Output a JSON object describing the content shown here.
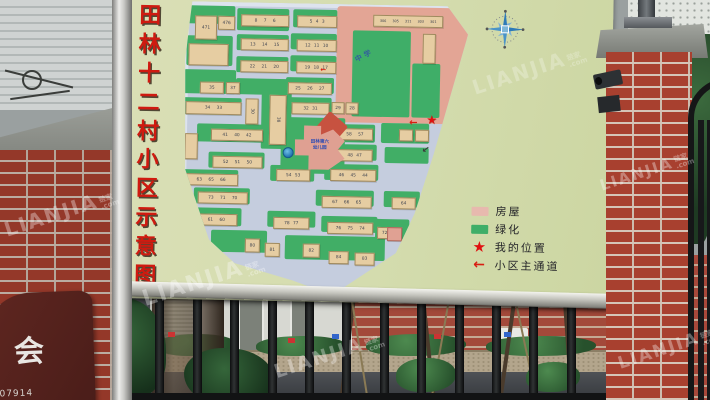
{
  "watermark": {
    "text": "LIANJIA",
    "cn": "链家",
    "com": ".com"
  },
  "left_sign": {
    "char": "会",
    "number": "07914"
  },
  "board": {
    "title_chars": [
      "田",
      "林",
      "十",
      "二",
      "村",
      "小",
      "区",
      "示",
      "意",
      "图"
    ],
    "top_road_label": "田林东路",
    "legend": [
      {
        "key": "house",
        "label": "房屋"
      },
      {
        "key": "green",
        "label": "绿化"
      },
      {
        "key": "star",
        "label": "我的位置"
      },
      {
        "key": "arrow",
        "label": "小区主通道"
      }
    ],
    "colors": {
      "board_face": "#d6dcae",
      "house": "#e6cda2",
      "green": "#41ae66",
      "road": "#c5cdde",
      "pink_zone": "#e3a595",
      "legend_house": "#e7b9ae",
      "marker_red": "#d81e12",
      "title_red": "#cf1a10"
    },
    "map": {
      "school_label": "中学",
      "kindergarten_lines": [
        "田林第六",
        "幼儿园"
      ],
      "greens": [
        [
          2,
          4,
          48,
          18
        ],
        [
          52,
          6,
          52,
          22
        ],
        [
          108,
          6,
          44,
          18
        ],
        [
          2,
          34,
          46,
          30
        ],
        [
          52,
          32,
          52,
          16
        ],
        [
          106,
          30,
          46,
          16
        ],
        [
          0,
          68,
          52,
          24
        ],
        [
          52,
          54,
          52,
          16
        ],
        [
          106,
          52,
          46,
          16
        ],
        [
          0,
          96,
          58,
          17
        ],
        [
          52,
          76,
          52,
          16
        ],
        [
          102,
          74,
          48,
          16
        ],
        [
          78,
          88,
          30,
          58
        ],
        [
          102,
          94,
          46,
          16
        ],
        [
          14,
          122,
          70,
          18
        ],
        [
          98,
          114,
          64,
          56
        ],
        [
          26,
          150,
          56,
          16
        ],
        [
          0,
          168,
          56,
          16
        ],
        [
          88,
          162,
          44,
          16
        ],
        [
          138,
          120,
          54,
          18
        ],
        [
          146,
          140,
          48,
          16
        ],
        [
          142,
          160,
          54,
          16
        ],
        [
          12,
          186,
          56,
          16
        ],
        [
          134,
          186,
          58,
          16
        ],
        [
          198,
          118,
          48,
          20
        ],
        [
          202,
          142,
          44,
          16
        ],
        [
          0,
          206,
          60,
          18
        ],
        [
          86,
          208,
          48,
          16
        ],
        [
          140,
          212,
          56,
          16
        ],
        [
          202,
          186,
          36,
          16
        ],
        [
          30,
          228,
          56,
          22
        ],
        [
          104,
          232,
          100,
          24
        ],
        [
          194,
          214,
          34,
          20
        ]
      ],
      "school_greens": [
        [
          168,
          26,
          58,
          86
        ],
        [
          228,
          58,
          28,
          54
        ]
      ],
      "buildings": [
        {
          "n": "471",
          "x": 10,
          "y": 14,
          "w": 20,
          "h": 22
        },
        {
          "n": "476",
          "x": 33,
          "y": 14,
          "w": 15,
          "h": 12
        },
        {
          "n": "8 7 6",
          "x": 56,
          "y": 12,
          "w": 46,
          "h": 10
        },
        {
          "n": "5 4 3",
          "x": 112,
          "y": 12,
          "w": 38,
          "h": 10
        },
        {
          "n": "306 305 311 303 301",
          "x": 188,
          "y": 10,
          "w": 68,
          "h": 10,
          "fs": 3.4
        },
        {
          "n": "",
          "x": 4,
          "y": 42,
          "w": 38,
          "h": 20
        },
        {
          "n": "13 14 15",
          "x": 56,
          "y": 36,
          "w": 46,
          "h": 10
        },
        {
          "n": "12 11 10",
          "x": 112,
          "y": 36,
          "w": 38,
          "h": 10
        },
        {
          "n": "22 21 20",
          "x": 56,
          "y": 58,
          "w": 46,
          "h": 10
        },
        {
          "n": "19 18 17",
          "x": 112,
          "y": 58,
          "w": 38,
          "h": 10
        },
        {
          "n": "35",
          "x": 16,
          "y": 80,
          "w": 22,
          "h": 10
        },
        {
          "n": "37",
          "x": 42,
          "y": 80,
          "w": 12,
          "h": 10
        },
        {
          "n": "25 26 27",
          "x": 104,
          "y": 79,
          "w": 42,
          "h": 10
        },
        {
          "n": "34 33",
          "x": 2,
          "y": 100,
          "w": 54,
          "h": 11
        },
        {
          "n": "30",
          "x": 62,
          "y": 96,
          "w": 11,
          "h": 24,
          "v": 1
        },
        {
          "n": "38",
          "x": 86,
          "y": 92,
          "w": 15,
          "h": 48,
          "v": 1
        },
        {
          "n": "32 31",
          "x": 108,
          "y": 99,
          "w": 36,
          "h": 10
        },
        {
          "n": "29",
          "x": 148,
          "y": 98,
          "w": 11,
          "h": 10
        },
        {
          "n": "28",
          "x": 162,
          "y": 98,
          "w": 11,
          "h": 10
        },
        {
          "n": "41 40 42",
          "x": 28,
          "y": 127,
          "w": 50,
          "h": 10
        },
        {
          "n": "",
          "x": 2,
          "y": 132,
          "w": 11,
          "h": 24
        },
        {
          "n": "59 58 57",
          "x": 142,
          "y": 124,
          "w": 46,
          "h": 10
        },
        {
          "n": "48 47",
          "x": 154,
          "y": 145,
          "w": 34,
          "h": 10
        },
        {
          "n": "46 45 44",
          "x": 148,
          "y": 165,
          "w": 44,
          "h": 10
        },
        {
          "n": "",
          "x": 216,
          "y": 124,
          "w": 12,
          "h": 10
        },
        {
          "n": "",
          "x": 232,
          "y": 124,
          "w": 12,
          "h": 10
        },
        {
          "n": "64",
          "x": 210,
          "y": 192,
          "w": 22,
          "h": 10
        },
        {
          "n": "52 51 50",
          "x": 30,
          "y": 154,
          "w": 48,
          "h": 10
        },
        {
          "n": "63 65 66",
          "x": 2,
          "y": 172,
          "w": 52,
          "h": 10
        },
        {
          "n": "54 53",
          "x": 94,
          "y": 166,
          "w": 32,
          "h": 10
        },
        {
          "n": "73 71 70",
          "x": 16,
          "y": 190,
          "w": 48,
          "h": 10
        },
        {
          "n": "67 66 65",
          "x": 140,
          "y": 192,
          "w": 48,
          "h": 10
        },
        {
          "n": "62 61 60",
          "x": 2,
          "y": 212,
          "w": 52,
          "h": 10
        },
        {
          "n": "78 77",
          "x": 92,
          "y": 214,
          "w": 34,
          "h": 10
        },
        {
          "n": "76 75 74",
          "x": 146,
          "y": 218,
          "w": 44,
          "h": 10
        },
        {
          "n": "72",
          "x": 196,
          "y": 222,
          "w": 13,
          "h": 10
        },
        {
          "n": "80",
          "x": 64,
          "y": 236,
          "w": 13,
          "h": 12
        },
        {
          "n": "81",
          "x": 84,
          "y": 240,
          "w": 13,
          "h": 12
        },
        {
          "n": "82",
          "x": 122,
          "y": 240,
          "w": 15,
          "h": 12
        },
        {
          "n": "84",
          "x": 148,
          "y": 247,
          "w": 18,
          "h": 11
        },
        {
          "n": "83",
          "x": 174,
          "y": 248,
          "w": 18,
          "h": 11
        },
        {
          "n": "",
          "x": 206,
          "y": 222,
          "w": 13,
          "h": 12,
          "c": "pink"
        },
        {
          "n": "",
          "x": 238,
          "y": 28,
          "w": 11,
          "h": 28
        }
      ]
    }
  }
}
